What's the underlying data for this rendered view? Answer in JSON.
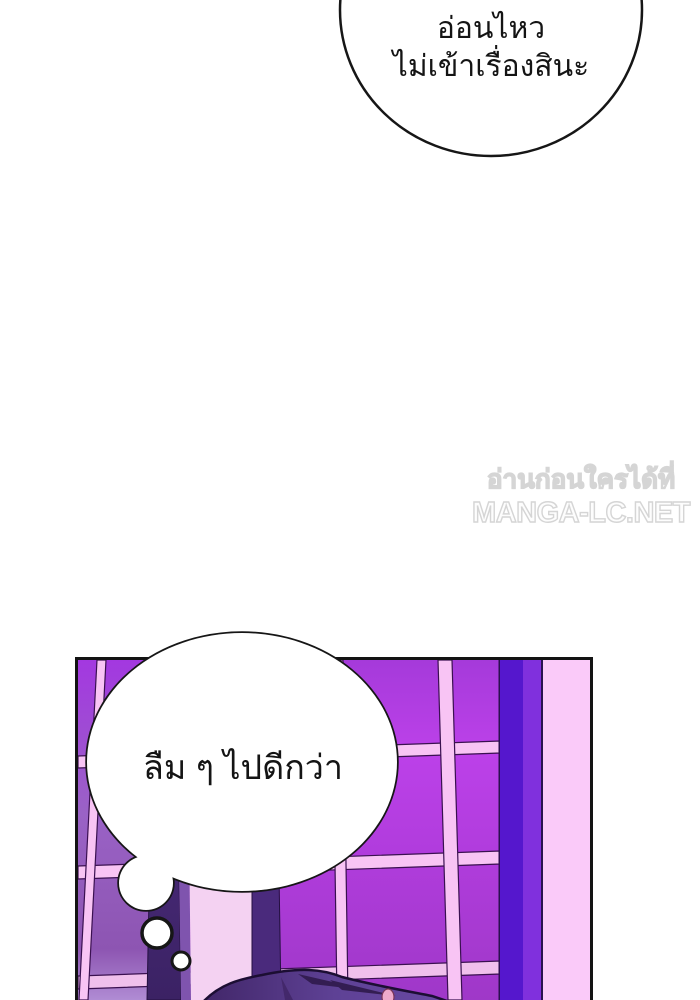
{
  "top_bubble": {
    "lines": [
      "อ่อนไหว",
      "ไม่เข้าเรื่องสินะ"
    ]
  },
  "watermark": {
    "line1": "อ่านก่อนใครได้ที่",
    "line2": "MANGA-LC.NET"
  },
  "thought_bubble": {
    "text": "ลืม ๆ ไปดีกว่า"
  },
  "palette": {
    "ink": "#141414",
    "watermark": "#d5d5d5",
    "paneBright": "#bc41e9",
    "paneMid": "#a53ada",
    "paneDeep": "#9f38c8",
    "paneLeftTop": "#a338e0",
    "paneLeftLow": "#8d55b2",
    "muntinPink": "#f8c4f4",
    "muntinEdge": "#3a1050",
    "pillarDark": "#4e2d80",
    "pillarDarker": "#3b2264",
    "indigoPillar": "#5517cd",
    "indigoLight": "#8030dd",
    "wallPinkRight": "#facaf9",
    "wallPinkCenter": "#f4d2f2",
    "hairPurple": "#5e4195",
    "hairShadow": "#331d52",
    "bubbleFill": "#ffffff"
  }
}
